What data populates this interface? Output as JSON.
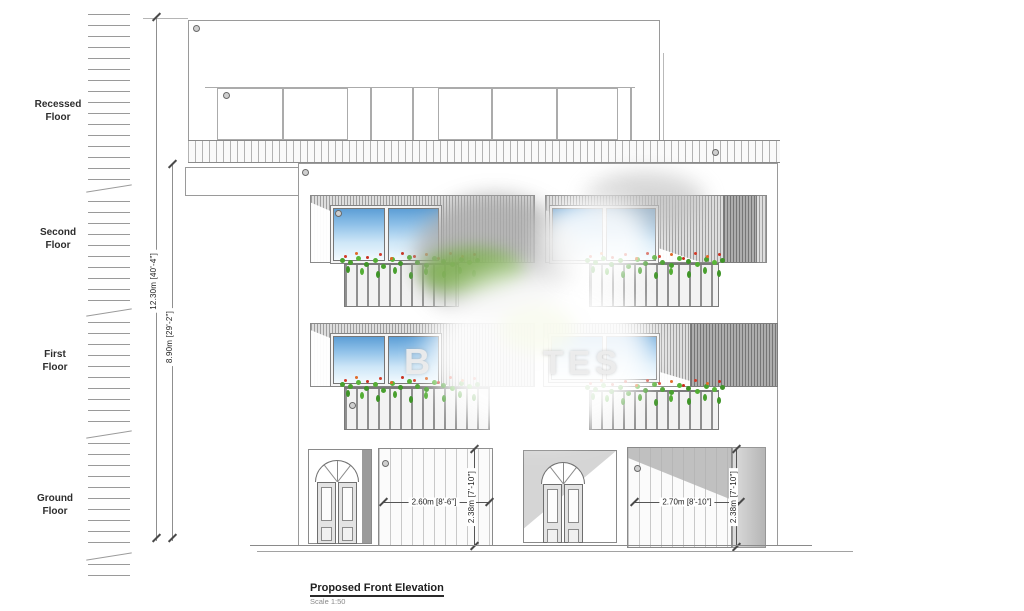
{
  "drawing": {
    "floors": [
      {
        "label_line1": "Recessed",
        "label_line2": "Floor"
      },
      {
        "label_line1": "Second",
        "label_line2": "Floor"
      },
      {
        "label_line1": "First",
        "label_line2": "Floor"
      },
      {
        "label_line1": "Ground",
        "label_line2": "Floor"
      }
    ],
    "dimensions": {
      "overall_height": "12.30m [40'-4\"]",
      "upper_height": "8.90m [29'-2\"]",
      "garage_left_width": "2.60m [8'-6\"]",
      "garage_left_height": "2.38m [7'-10\"]",
      "garage_right_width": "2.70m [8'-10\"]",
      "garage_right_height": "2.38m [7'-10\"]"
    },
    "watermark": {
      "left_fragment": "B",
      "right_fragment": "TES"
    },
    "title": "Proposed Front Elevation",
    "scale": "Scale 1:50",
    "colors": {
      "linework": "#8a8a8a",
      "glass_top": "#5d9fd6",
      "glass_bottom": "#f3fafe",
      "foliage": "#49a02e",
      "flower": "#d43c2a"
    }
  }
}
